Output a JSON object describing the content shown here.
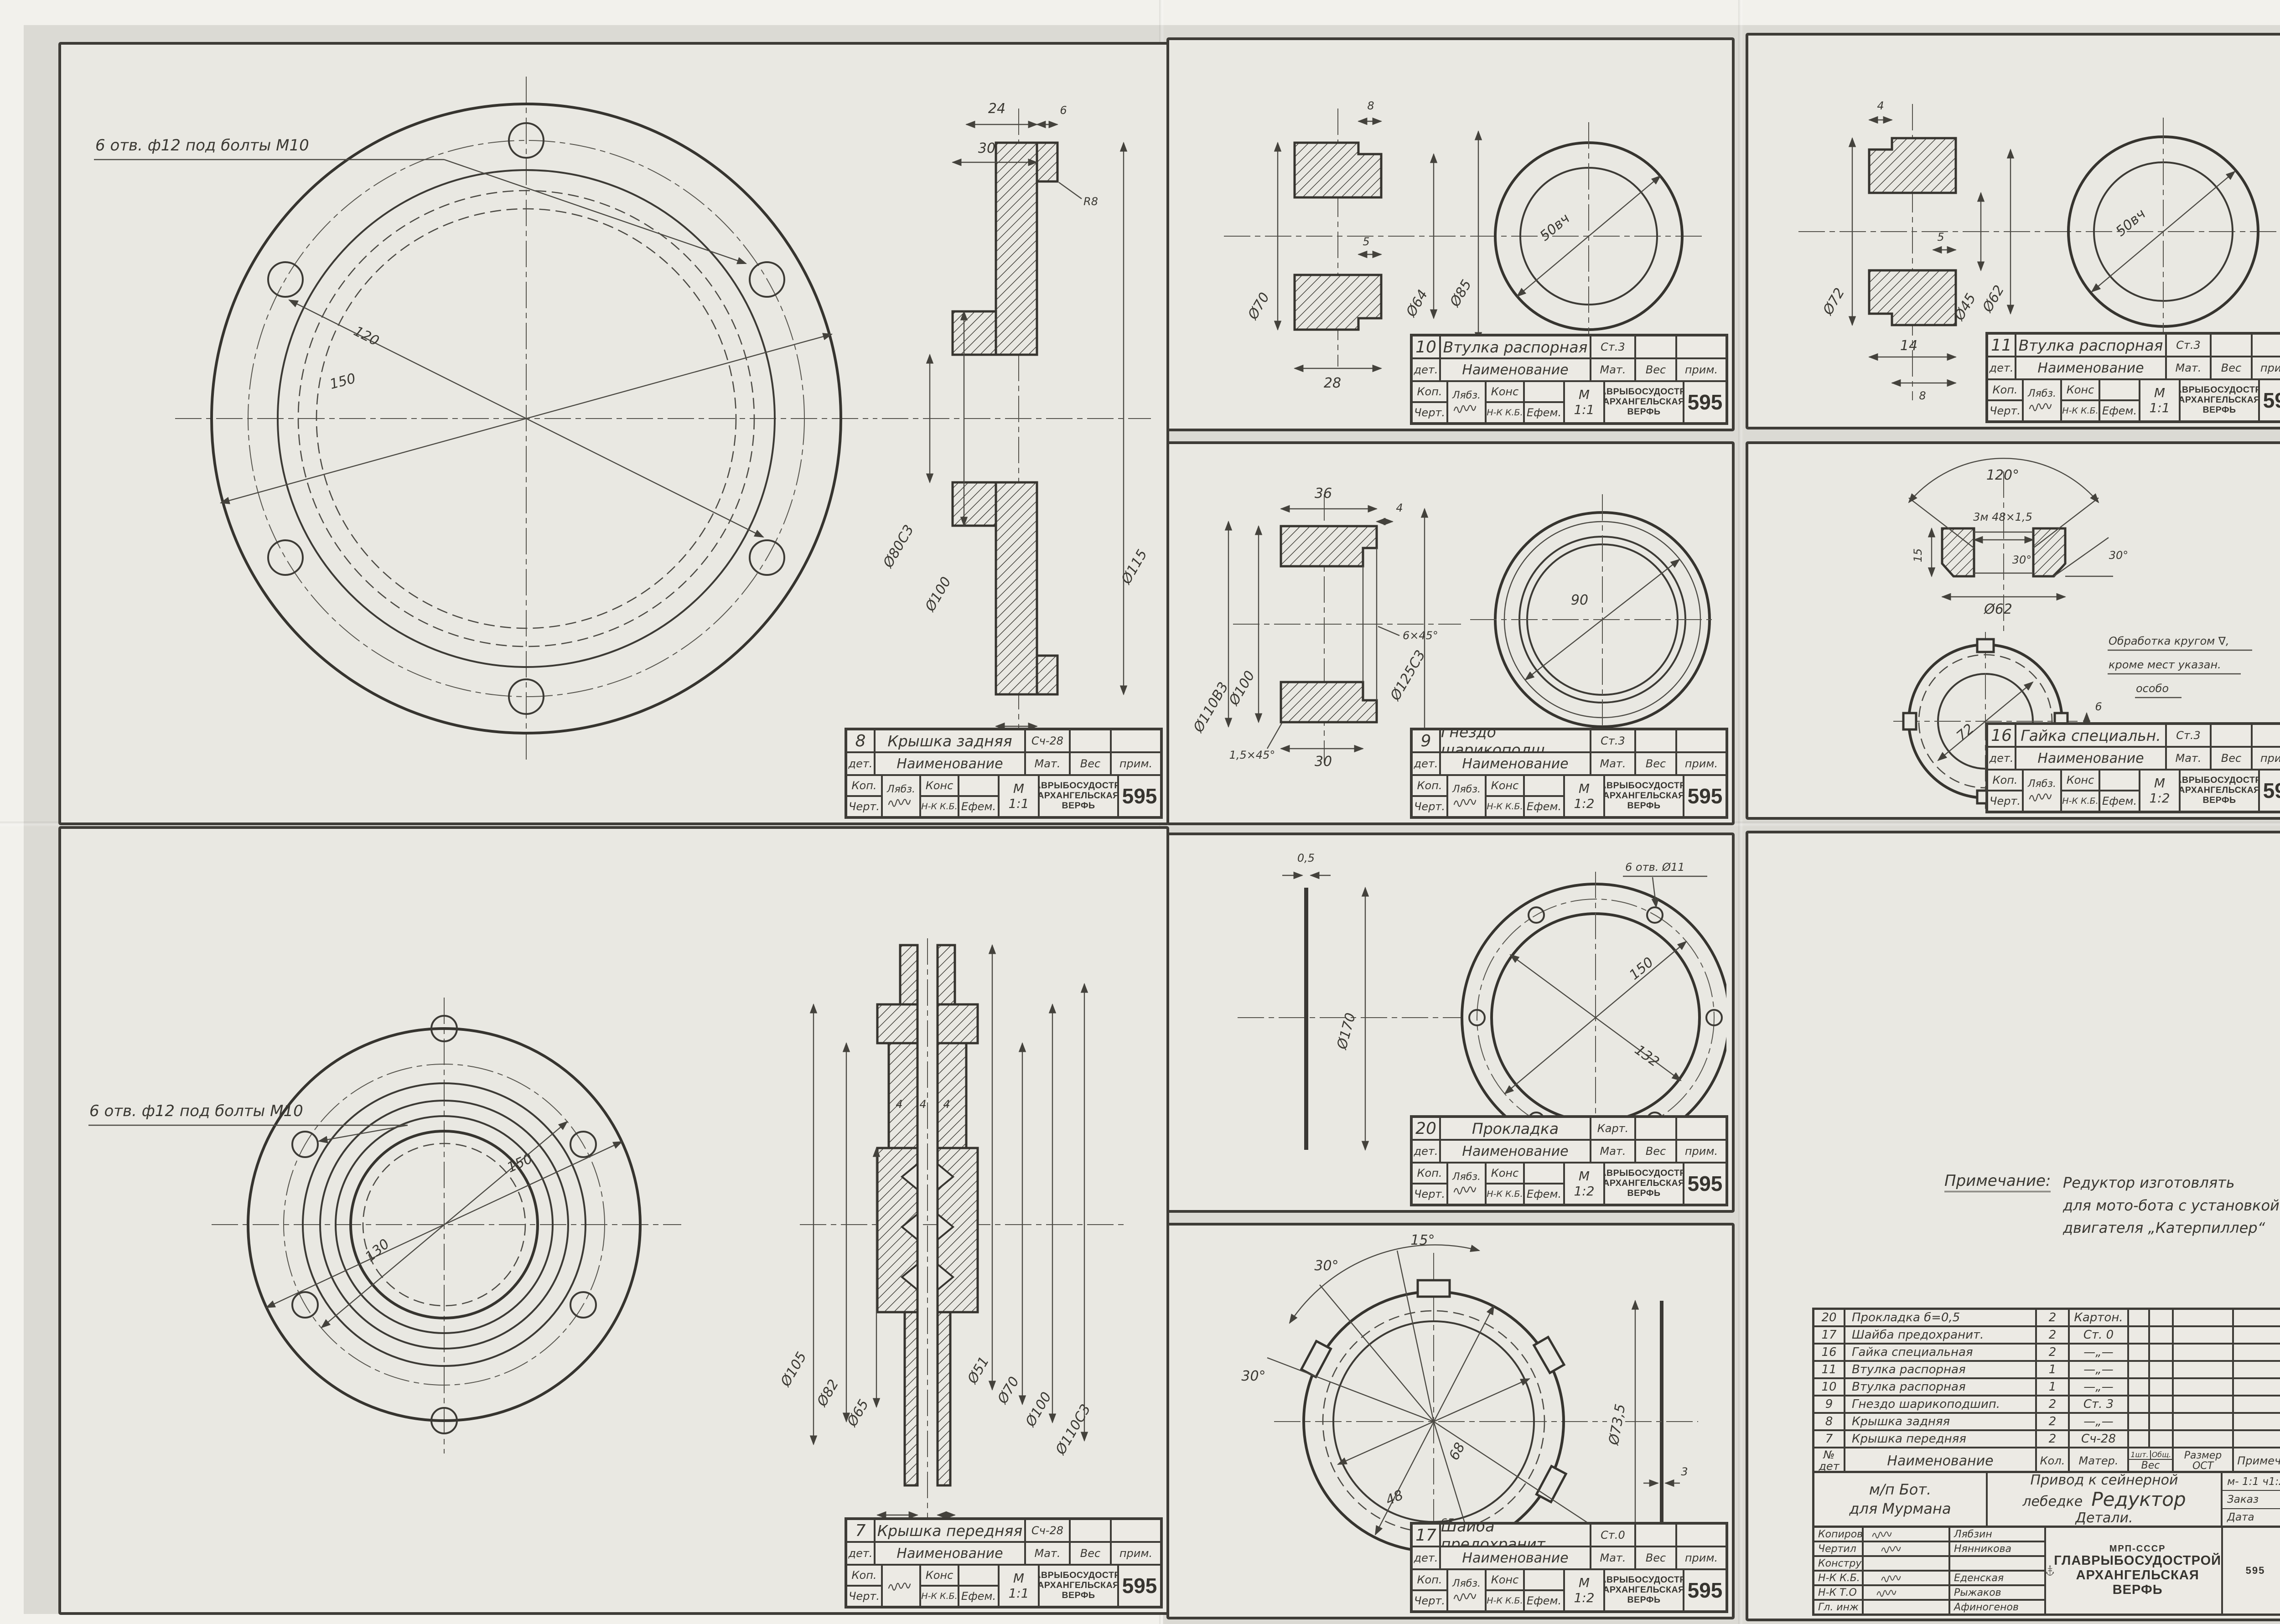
{
  "tb": {
    "det": "дет.",
    "naim": "Наименование",
    "mat": "Мат.",
    "ves": "Вес",
    "prim": "прим.",
    "kop": "Коп.",
    "chert": "Черт.",
    "kons": "Конс",
    "nkkb": "Н-К К.Б.",
    "m": "М",
    "org1": "ГЛАВРЫБОСУДОСТРОЙ",
    "org2": "АРХАНГЕЛЬСКАЯ",
    "org3": "ВЕРФЬ",
    "sheet": "595",
    "sig_kop": "Лябз.",
    "sig_che": "Ефем."
  },
  "panels": {
    "p8": {
      "num": "8",
      "name": "Крышка задняя",
      "mat": "Сч-28",
      "scale": "1:1",
      "note": "6 отв. ф12 под болты М10",
      "dims": {
        "d1": "120",
        "d2": "150",
        "w24": "24",
        "w30": "30",
        "w6": "6",
        "r8": "R8",
        "d80": "Ø80С3",
        "d100": "Ø100",
        "d115": "Ø115",
        "t8": "8"
      }
    },
    "p7": {
      "num": "7",
      "name": "Крышка передняя",
      "mat": "Сч-28",
      "scale": "1:1",
      "note": "6 отв. ф12 под болты М10",
      "dims": {
        "d1": "130",
        "d2": "150",
        "g1": "4",
        "g2": "4",
        "g3": "4",
        "d105": "Ø105",
        "d82": "Ø82",
        "d65": "Ø65",
        "d51": "Ø51",
        "d70": "Ø70",
        "d100": "Ø100",
        "d110": "Ø110С3",
        "t8": "8",
        "t4": "4",
        "w20": "20"
      }
    },
    "p10": {
      "num": "10",
      "name": "Втулка распорная",
      "mat": "Ст.3",
      "scale": "1:1",
      "dims": {
        "t8": "8",
        "t5": "5",
        "d70": "Ø70",
        "d64": "Ø64",
        "d85": "Ø85",
        "w28": "28",
        "d50": "50вч"
      }
    },
    "p11": {
      "num": "11",
      "name": "Втулка распорная",
      "mat": "Ст.3",
      "scale": "1:1",
      "dims": {
        "t4": "4",
        "t5": "5",
        "d72": "Ø72",
        "d62": "Ø62",
        "d45": "Ø45",
        "w14": "14",
        "t8": "8",
        "d50": "50вч"
      }
    },
    "p9": {
      "num": "9",
      "name": "Гнездо шарикоподш.",
      "mat": "Ст.3",
      "scale": "1:2",
      "dims": {
        "w36": "36",
        "t4": "4",
        "d100": "Ø100",
        "d110": "Ø110В3",
        "d125": "Ø125С3",
        "ch1": "1,5×45°",
        "ch2": "6×45°",
        "w30": "30",
        "d90": "90"
      }
    },
    "p20": {
      "num": "20",
      "name": "Прокладка",
      "mat": "Карт.",
      "scale": "1:2",
      "note": "6 отв. Ø11",
      "dims": {
        "t05": "0,5",
        "d170": "Ø170",
        "d150": "150",
        "d132": "132"
      }
    },
    "p17": {
      "num": "17",
      "name": "Шайба предохранит.",
      "mat": "Ст.0",
      "scale": "1:2",
      "dims": {
        "a15": "15°",
        "a30a": "30°",
        "a30b": "30°",
        "a30c": "30°",
        "a30d": "30°",
        "d68": "68",
        "d48": "48",
        "w65": "65",
        "w55": "55",
        "d735": "Ø73,5",
        "t3": "3"
      }
    },
    "p16": {
      "num": "16",
      "name": "Гайка специальн.",
      "mat": "Ст.3",
      "scale": "1:2",
      "note1": "Обработка кругом ∇,",
      "note2": "кроме мест указан.",
      "note3": "особо",
      "dims": {
        "a120": "120°",
        "thr": "3м 48×1,5",
        "h15": "15",
        "a30a": "30°",
        "a30b": "30°",
        "d62": "Ø62",
        "d72": "72",
        "w6": "6",
        "w5": "5"
      }
    }
  },
  "main": {
    "note": {
      "label": "Примечание:",
      "l1": "Редуктор изготовлять",
      "l2": "для мото-бота с установкой",
      "l3": "двигателя „Катерпиллер“"
    },
    "parts": [
      {
        "num": "20",
        "name": "Прокладка б=0,5",
        "qty": "2",
        "mat": "Картон."
      },
      {
        "num": "17",
        "name": "Шайба предохранит.",
        "qty": "2",
        "mat": "Ст. 0"
      },
      {
        "num": "16",
        "name": "Гайка специальная",
        "qty": "2",
        "mat": "—„—"
      },
      {
        "num": "11",
        "name": "Втулка распорная",
        "qty": "1",
        "mat": "—„—"
      },
      {
        "num": "10",
        "name": "Втулка распорная",
        "qty": "1",
        "mat": "—„—"
      },
      {
        "num": "9",
        "name": "Гнездо шарикоподшип.",
        "qty": "2",
        "mat": "Ст. 3"
      },
      {
        "num": "8",
        "name": "Крышка задняя",
        "qty": "2",
        "mat": "—„—"
      },
      {
        "num": "7",
        "name": "Крышка передняя",
        "qty": "2",
        "mat": "Сч-28"
      }
    ],
    "ph": {
      "n1": "№",
      "n2": "дет",
      "name": "Наименование",
      "qty": "Кол.",
      "mat": "Матер.",
      "v1": "1шт.",
      "v2": "Общ.",
      "ves": "Вес",
      "r1": "Размер",
      "r2": "ОСТ",
      "prim": "Примеч."
    },
    "proj": {
      "l1": "м/п Бот.",
      "l2": "для Мурмана",
      "t1": "Привод к сейнерной",
      "t2": "лебедке",
      "t3": "Редуктор",
      "t4": "Детали.",
      "scale": "м- 1:1  ч1:2",
      "zakaz": "Заказ",
      "data": "Дата"
    },
    "roles": [
      {
        "r": "Копиров.",
        "n": "Лябзин"
      },
      {
        "r": "Чертил",
        "n": "Нянникова"
      },
      {
        "r": "Конструк.",
        "n": ""
      },
      {
        "r": "Н-К К.Б.",
        "n": "Еденская"
      },
      {
        "r": "Н-К Т.О",
        "n": "Рыжаков"
      },
      {
        "r": "Гл. инж",
        "n": "Афиногенов"
      }
    ],
    "org": {
      "logo": "АСВ",
      "abbr": "МРП-СССР",
      "l1": "ГЛАВРЫБОСУДОСТРОЙ",
      "l2": "АРХАНГЕЛЬСКАЯ",
      "l3": "ВЕРФЬ"
    },
    "number": "595"
  }
}
